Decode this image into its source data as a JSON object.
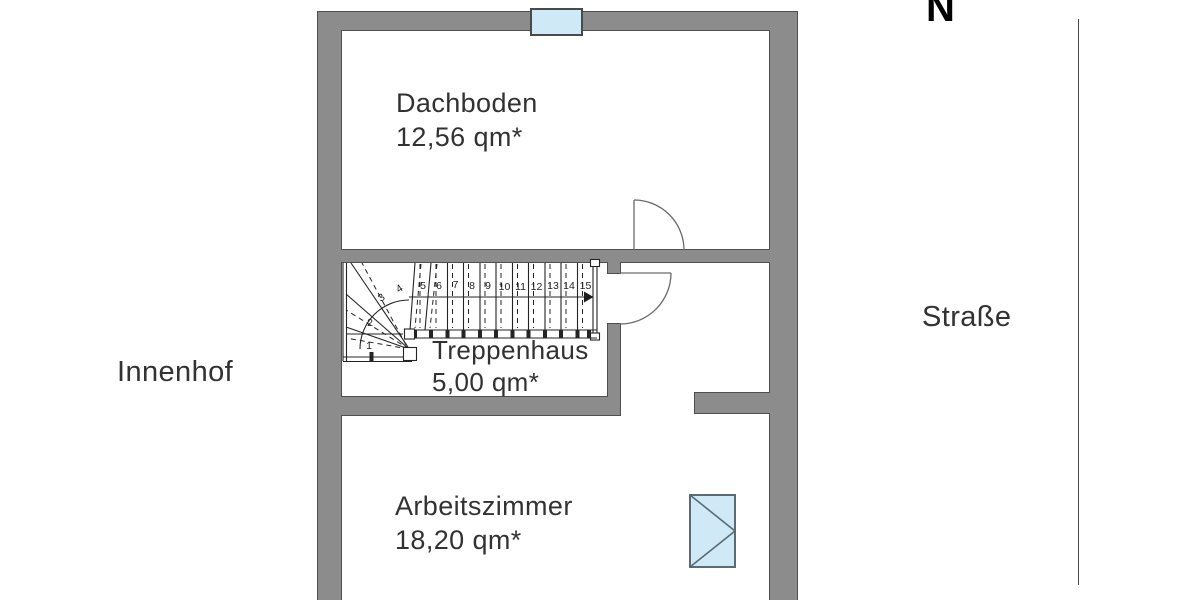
{
  "plan": {
    "north_indicator": {
      "label": "N"
    },
    "context": {
      "left_label": "Innenhof",
      "right_label": "Straße"
    },
    "rooms": [
      {
        "name": "Dachboden",
        "area": "12,56 qm*"
      },
      {
        "name": "Treppenhaus",
        "area": "5,00 qm*"
      },
      {
        "name": "Arbeitszimmer",
        "area": "18,20 qm*"
      }
    ],
    "stair": {
      "steps": [
        "1",
        "2",
        "3",
        "4",
        "5",
        "6",
        "7",
        "8",
        "9",
        "10",
        "11",
        "12",
        "13",
        "14",
        "15"
      ]
    },
    "symbols": {
      "top_window": "window",
      "study_window": "casement-window-opening-right",
      "doors": "door-swing-arc"
    },
    "colors": {
      "wall": "#8c8c8c",
      "wall_outline": "#4f4f4f",
      "window_fill": "#cfe9f6",
      "line": "#242424"
    }
  }
}
